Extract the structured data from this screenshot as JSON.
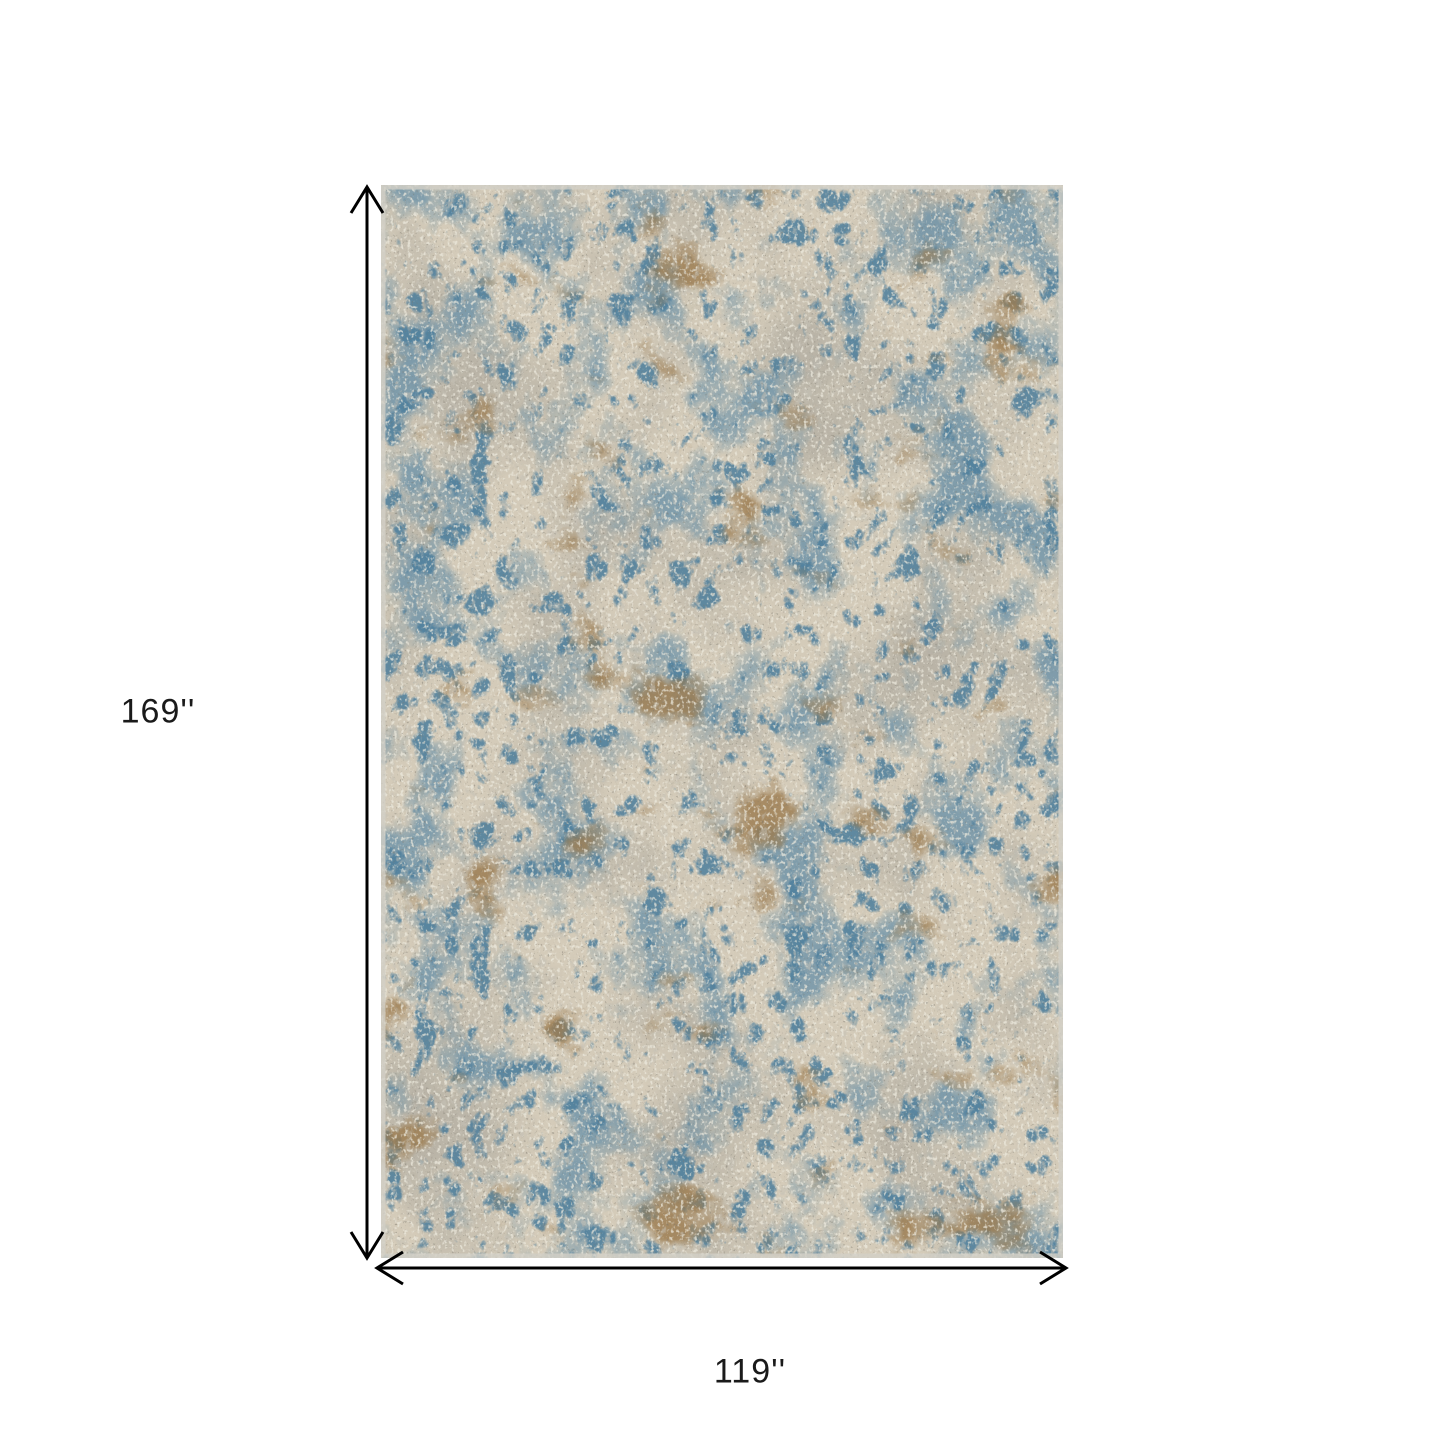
{
  "diagram": {
    "height_label": "169''",
    "width_label": "119''",
    "icons": {
      "vertical_arrow": "double-headed-dimension-arrow",
      "horizontal_arrow": "double-headed-dimension-arrow"
    },
    "colors": {
      "background": "#ffffff",
      "arrow": "#000000",
      "label_text": "#1a1a1a",
      "rug_base": "#d4cbb9",
      "rug_gray": "#a9a69c",
      "rug_blue_light": "#6e94aa",
      "rug_blue_deep": "#4e7f9d",
      "rug_tan": "#9d7c4f",
      "rug_white_speck": "#edeade",
      "rug_dark_speck": "#7b776c",
      "rug_edge": "#d2cfc7"
    }
  }
}
